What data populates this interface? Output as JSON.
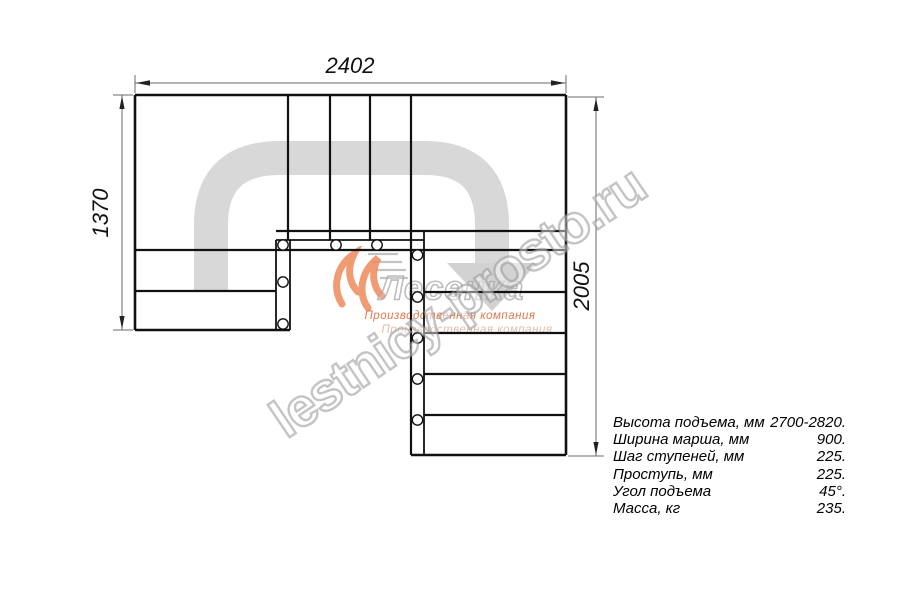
{
  "drawing": {
    "type": "staircase-plan-top-view",
    "dimensions": {
      "top_width_mm": "2402",
      "left_height_mm": "1370",
      "right_height_mm": "2005"
    },
    "colors": {
      "line": "#111111",
      "dimension_line": "#6b6b6b",
      "route_arrow": "#d8d8d8",
      "logo_orange": "#ef8a5c",
      "watermark_gray": "#949494"
    }
  },
  "logo": {
    "company": "Лесенка",
    "tagline": "Производственная компания",
    "tagline2": "Производственная компания"
  },
  "watermark": {
    "text": "lestnicy-prosto.ru"
  },
  "specs": {
    "rows": [
      {
        "label": "Высота подъема, мм",
        "value": "2700-2820."
      },
      {
        "label": "Ширина марша, мм",
        "value": "900."
      },
      {
        "label": "Шаг ступеней, мм",
        "value": "225."
      },
      {
        "label": "Проступь, мм",
        "value": "225."
      },
      {
        "label": "Угол подъема",
        "value": "45°."
      },
      {
        "label": "Масса, кг",
        "value": "235."
      }
    ]
  }
}
